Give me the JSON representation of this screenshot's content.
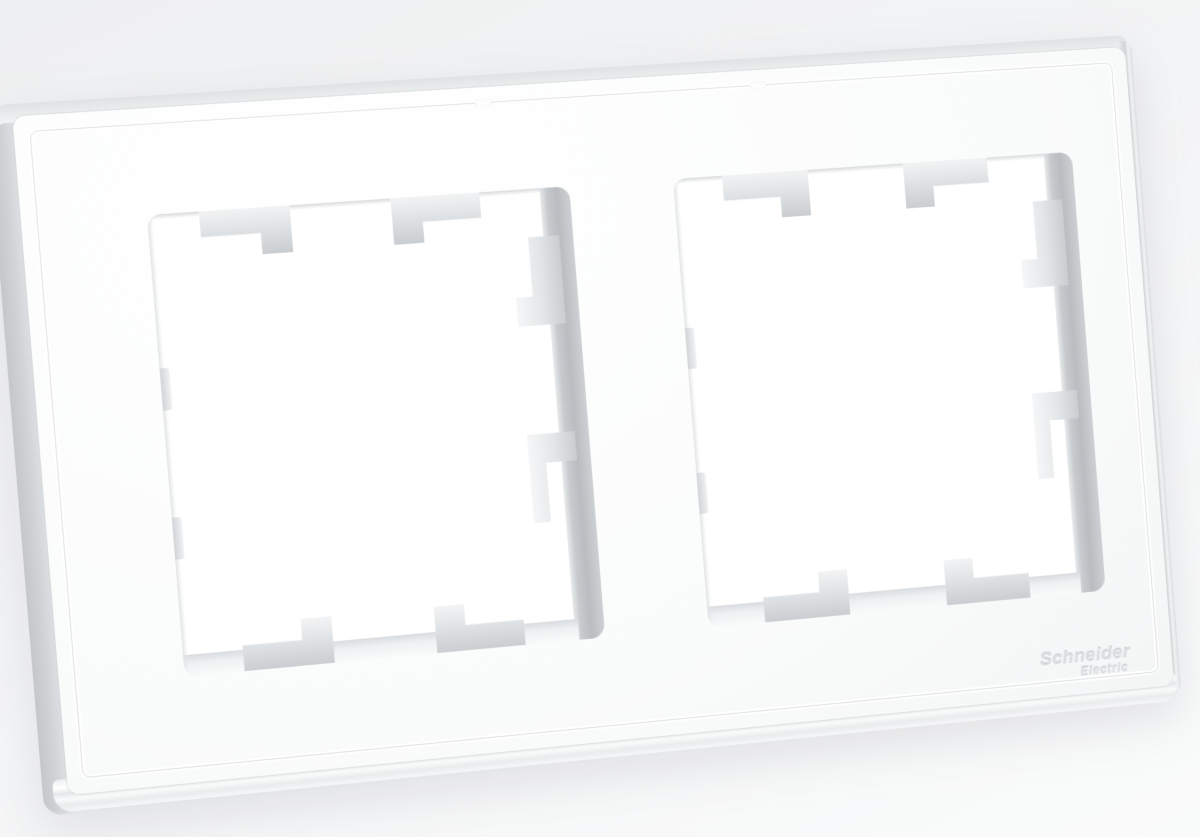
{
  "scene": {
    "description": "Product photo of a white two-gang wall switch frame on a plain light background, slightly rotated"
  },
  "brand": {
    "line1": "Schneider",
    "line2": "Electric"
  },
  "product": {
    "openings": 2,
    "clips_per_opening": {
      "top": 2,
      "bottom": 2,
      "right": 2,
      "left_stubs": 2
    }
  },
  "colors": {
    "background_top": "#eff0f1",
    "background_bottom": "#fafbfb",
    "face_highlight": "#ffffff",
    "face_shade": "#eef0f1",
    "side_edge": "#d2d5d8",
    "inner_wall": "#b9bdc0",
    "clip_light": "#f2f3f4",
    "clip_dark": "#c9cdd0",
    "logo_text": "#dbdee1"
  }
}
